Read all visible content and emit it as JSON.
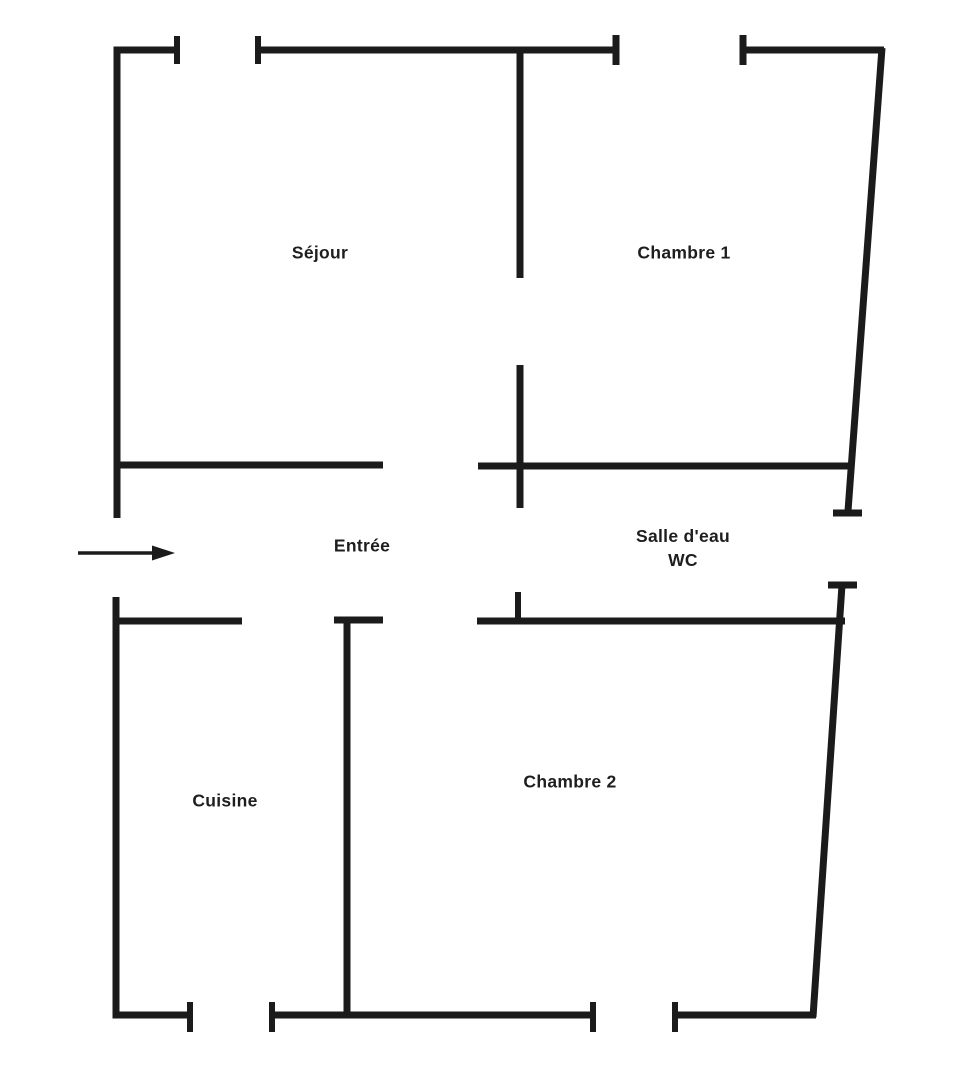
{
  "floor_plan": {
    "background_color": "#ffffff",
    "wall_color": "#1b1b1b",
    "text_color": "#1e1e1e",
    "rooms": [
      {
        "name": "sejour",
        "label": "Séjour"
      },
      {
        "name": "chambre-1",
        "label": "Chambre 1"
      },
      {
        "name": "entree",
        "label": "Entrée"
      },
      {
        "name": "salle-deau-wc",
        "label": "Salle d'eau",
        "label_line2": "WC"
      },
      {
        "name": "cuisine",
        "label": "Cuisine"
      },
      {
        "name": "chambre-2",
        "label": "Chambre 2"
      }
    ],
    "entrance_arrow": {
      "direction": "right",
      "shaft": {
        "x1": 78,
        "y1": 553,
        "x2": 154,
        "y2": 553,
        "w": 3.5
      },
      "head_points": "175,553 152,545.5 152,560.5"
    },
    "walls": [
      {
        "x1": 117,
        "y1": 46.5,
        "x2": 117,
        "y2": 518,
        "w": 7
      },
      {
        "x1": 113.5,
        "y1": 50,
        "x2": 177,
        "y2": 50,
        "w": 7
      },
      {
        "x1": 177,
        "y1": 36,
        "x2": 177,
        "y2": 64,
        "w": 6
      },
      {
        "x1": 258,
        "y1": 36,
        "x2": 258,
        "y2": 64,
        "w": 6
      },
      {
        "x1": 258,
        "y1": 50,
        "x2": 616,
        "y2": 50,
        "w": 7
      },
      {
        "x1": 616,
        "y1": 35,
        "x2": 616,
        "y2": 65,
        "w": 7
      },
      {
        "x1": 743,
        "y1": 35,
        "x2": 743,
        "y2": 65,
        "w": 7
      },
      {
        "x1": 743,
        "y1": 50,
        "x2": 884,
        "y2": 50,
        "w": 7
      },
      {
        "x1": 882,
        "y1": 48,
        "x2": 848,
        "y2": 511,
        "w": 7
      },
      {
        "x1": 833,
        "y1": 513,
        "x2": 862,
        "y2": 513,
        "w": 7
      },
      {
        "x1": 520,
        "y1": 47,
        "x2": 520,
        "y2": 278,
        "w": 7
      },
      {
        "x1": 520,
        "y1": 365,
        "x2": 520,
        "y2": 508,
        "w": 7
      },
      {
        "x1": 117,
        "y1": 465,
        "x2": 383,
        "y2": 465,
        "w": 7
      },
      {
        "x1": 478,
        "y1": 466,
        "x2": 852,
        "y2": 466,
        "w": 7
      },
      {
        "x1": 116,
        "y1": 597,
        "x2": 116,
        "y2": 1018.5,
        "w": 7
      },
      {
        "x1": 112.5,
        "y1": 621,
        "x2": 242,
        "y2": 621,
        "w": 7
      },
      {
        "x1": 334,
        "y1": 620,
        "x2": 383,
        "y2": 620,
        "w": 7
      },
      {
        "x1": 347,
        "y1": 620,
        "x2": 347,
        "y2": 1017,
        "w": 7
      },
      {
        "x1": 477,
        "y1": 621,
        "x2": 845,
        "y2": 621,
        "w": 7
      },
      {
        "x1": 518,
        "y1": 592,
        "x2": 518,
        "y2": 624,
        "w": 6
      },
      {
        "x1": 828,
        "y1": 585,
        "x2": 857,
        "y2": 585,
        "w": 7
      },
      {
        "x1": 842,
        "y1": 585,
        "x2": 813,
        "y2": 1017,
        "w": 7
      },
      {
        "x1": 112.5,
        "y1": 1015,
        "x2": 190,
        "y2": 1015,
        "w": 7
      },
      {
        "x1": 190,
        "y1": 1002,
        "x2": 190,
        "y2": 1032,
        "w": 6
      },
      {
        "x1": 272,
        "y1": 1002,
        "x2": 272,
        "y2": 1032,
        "w": 6
      },
      {
        "x1": 272,
        "y1": 1015,
        "x2": 593,
        "y2": 1015,
        "w": 7
      },
      {
        "x1": 593,
        "y1": 1002,
        "x2": 593,
        "y2": 1032,
        "w": 6
      },
      {
        "x1": 675,
        "y1": 1002,
        "x2": 675,
        "y2": 1032,
        "w": 6
      },
      {
        "x1": 675,
        "y1": 1015,
        "x2": 816,
        "y2": 1015,
        "w": 7
      }
    ]
  }
}
